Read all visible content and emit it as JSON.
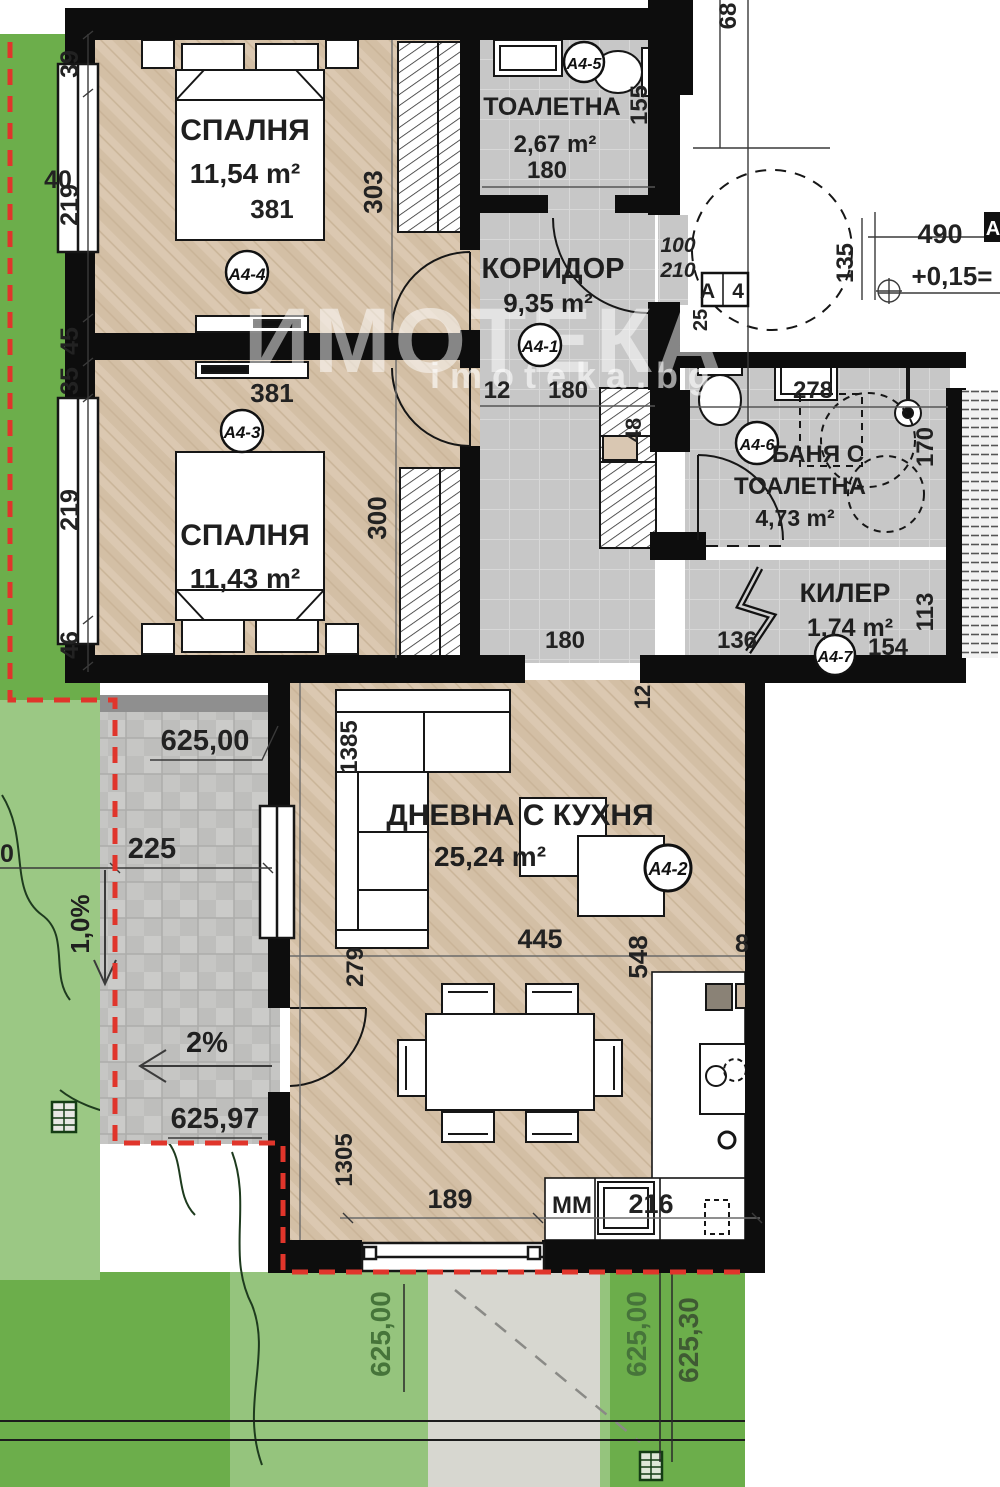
{
  "watermark": {
    "brand": "ИМОТЕКА",
    "site": "imoteka.bg"
  },
  "rooms": {
    "bedroom1": {
      "name": "СПАЛНЯ",
      "area": "11,54 m²",
      "tag": "A4-4",
      "bed_width": "381",
      "depth": "303"
    },
    "toilet": {
      "name": "ТОАЛЕТНА",
      "area": "2,67 m²",
      "tag": "A4-5",
      "width": "180",
      "depth": "155"
    },
    "corridor": {
      "name": "КОРИДОР",
      "area": "9,35 m²",
      "tag": "A4-1",
      "wall_thickness": "12",
      "width": "180",
      "bottom_width": "180",
      "closet_depth": "48",
      "stub": "12"
    },
    "bedroom2": {
      "name": "СПАЛНЯ",
      "area": "11,43 m²",
      "tag": "A4-3",
      "bed_width": "381",
      "depth": "300"
    },
    "bath": {
      "name_line1": "БАНЯ С",
      "name_line2": "ТОАЛЕТНА",
      "area": "4,73 m²",
      "tag": "A4-6",
      "width": "278",
      "depth": "170"
    },
    "storage": {
      "name": "КИЛЕР",
      "area": "1,74 m²",
      "tag": "A4-7",
      "width_left": "136",
      "width_right": "154",
      "depth": "113"
    },
    "living": {
      "name": "ДНЕВНА С КУХНЯ",
      "area": "25,24 m²",
      "tag": "A4-2",
      "dim_sofa_wall": "1385",
      "dim_left": "279",
      "dim_width": "445",
      "dim_kitchen": "548",
      "dim_door": "189",
      "dim_bottom_left": "1305",
      "dim_appliance": "216",
      "dim_cut": "8",
      "washer_label": "ММ"
    }
  },
  "exterior": {
    "left_dims": [
      "39",
      "219",
      "45",
      "35",
      "219",
      "46"
    ],
    "window_width": "40",
    "top_dim_cut": "68",
    "patio": {
      "elev_top": "625,00",
      "elev_bottom": "625,97",
      "width": "225",
      "width_cut": "0",
      "slope_down": "1,0%",
      "slope_left": "2%"
    },
    "garden": {
      "elev_left": "625,00",
      "elev_mid": "625,00",
      "elev_right": "625,30"
    },
    "top_right": {
      "width": "490",
      "level": "+0,15=",
      "offset": "135",
      "door_w": "100",
      "door_h": "210",
      "wall": "25",
      "section": "A 4",
      "section_cut": "A"
    }
  }
}
